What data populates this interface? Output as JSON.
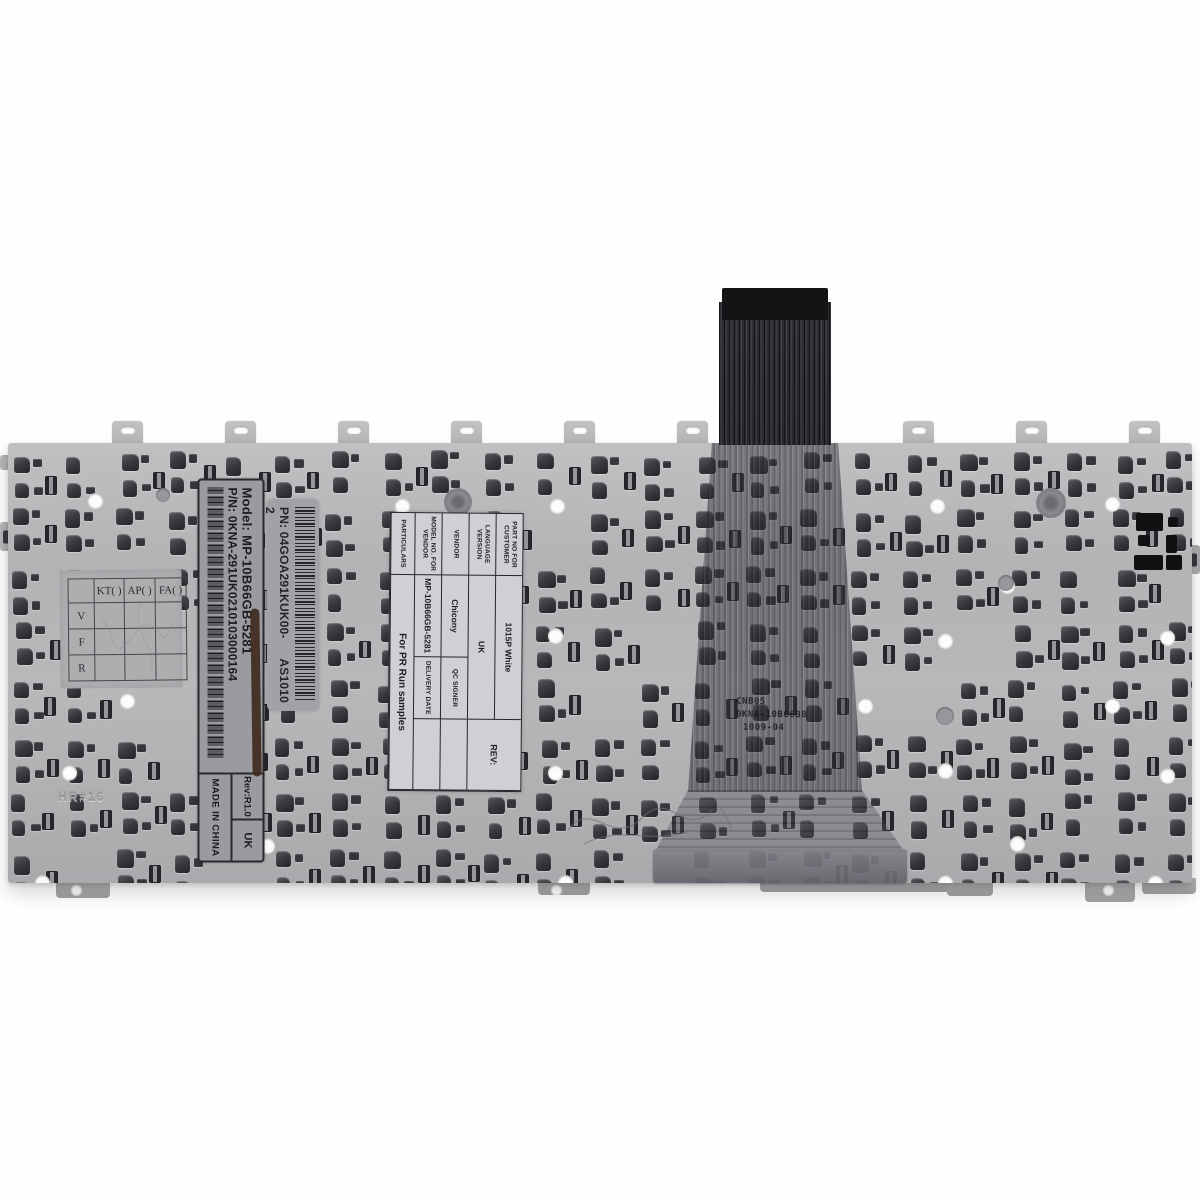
{
  "labels": {
    "model_label": {
      "model": "Model: MP-10B66GB-5281",
      "part_number": "P/N: 0KNA-291UK0210103000164",
      "rev": "Rev:R1.0",
      "language": "UK",
      "origin": "MADE IN CHINA"
    },
    "pn_label": {
      "part_number": "PN: 04GOA291KUK00-2",
      "code": "AS1010"
    },
    "qc_grid": {
      "columns": [
        "KT( )",
        "AP( )",
        "FA( )"
      ],
      "rows": [
        "V",
        "F",
        "R"
      ]
    },
    "spec_label": {
      "rows": [
        {
          "label": "PART NO FOR CUSTOMER",
          "value": "1015P White"
        },
        {
          "label": "LANGUAGE VERSION",
          "value": "UK"
        },
        {
          "label": "VENDOR",
          "value": "Chicony"
        },
        {
          "label": "MODEL NO. FOR VENDOR",
          "value": "MP-10B66GB-5281"
        },
        {
          "label": "PARTICULARS",
          "value": "For PR Run samples"
        }
      ],
      "rev": "REV:",
      "qc_signer": "QC SIGNER",
      "delivery_date": "DELIVERY DATE"
    },
    "cable_stamp": {
      "line1": "CNB05",
      "line2": "0KNA-10B66B8",
      "line3": "1009-04"
    },
    "plate_stamp": "HR#16"
  },
  "colors": {
    "background": "#ffffff",
    "plate_gray": "#b4b4b6",
    "hook_dark": "#38383c",
    "cable_dark": "#28282c",
    "label_gray": "#9b9b9f",
    "label_white": "#d0d0d4",
    "marker_streak": "#3f2b20"
  }
}
